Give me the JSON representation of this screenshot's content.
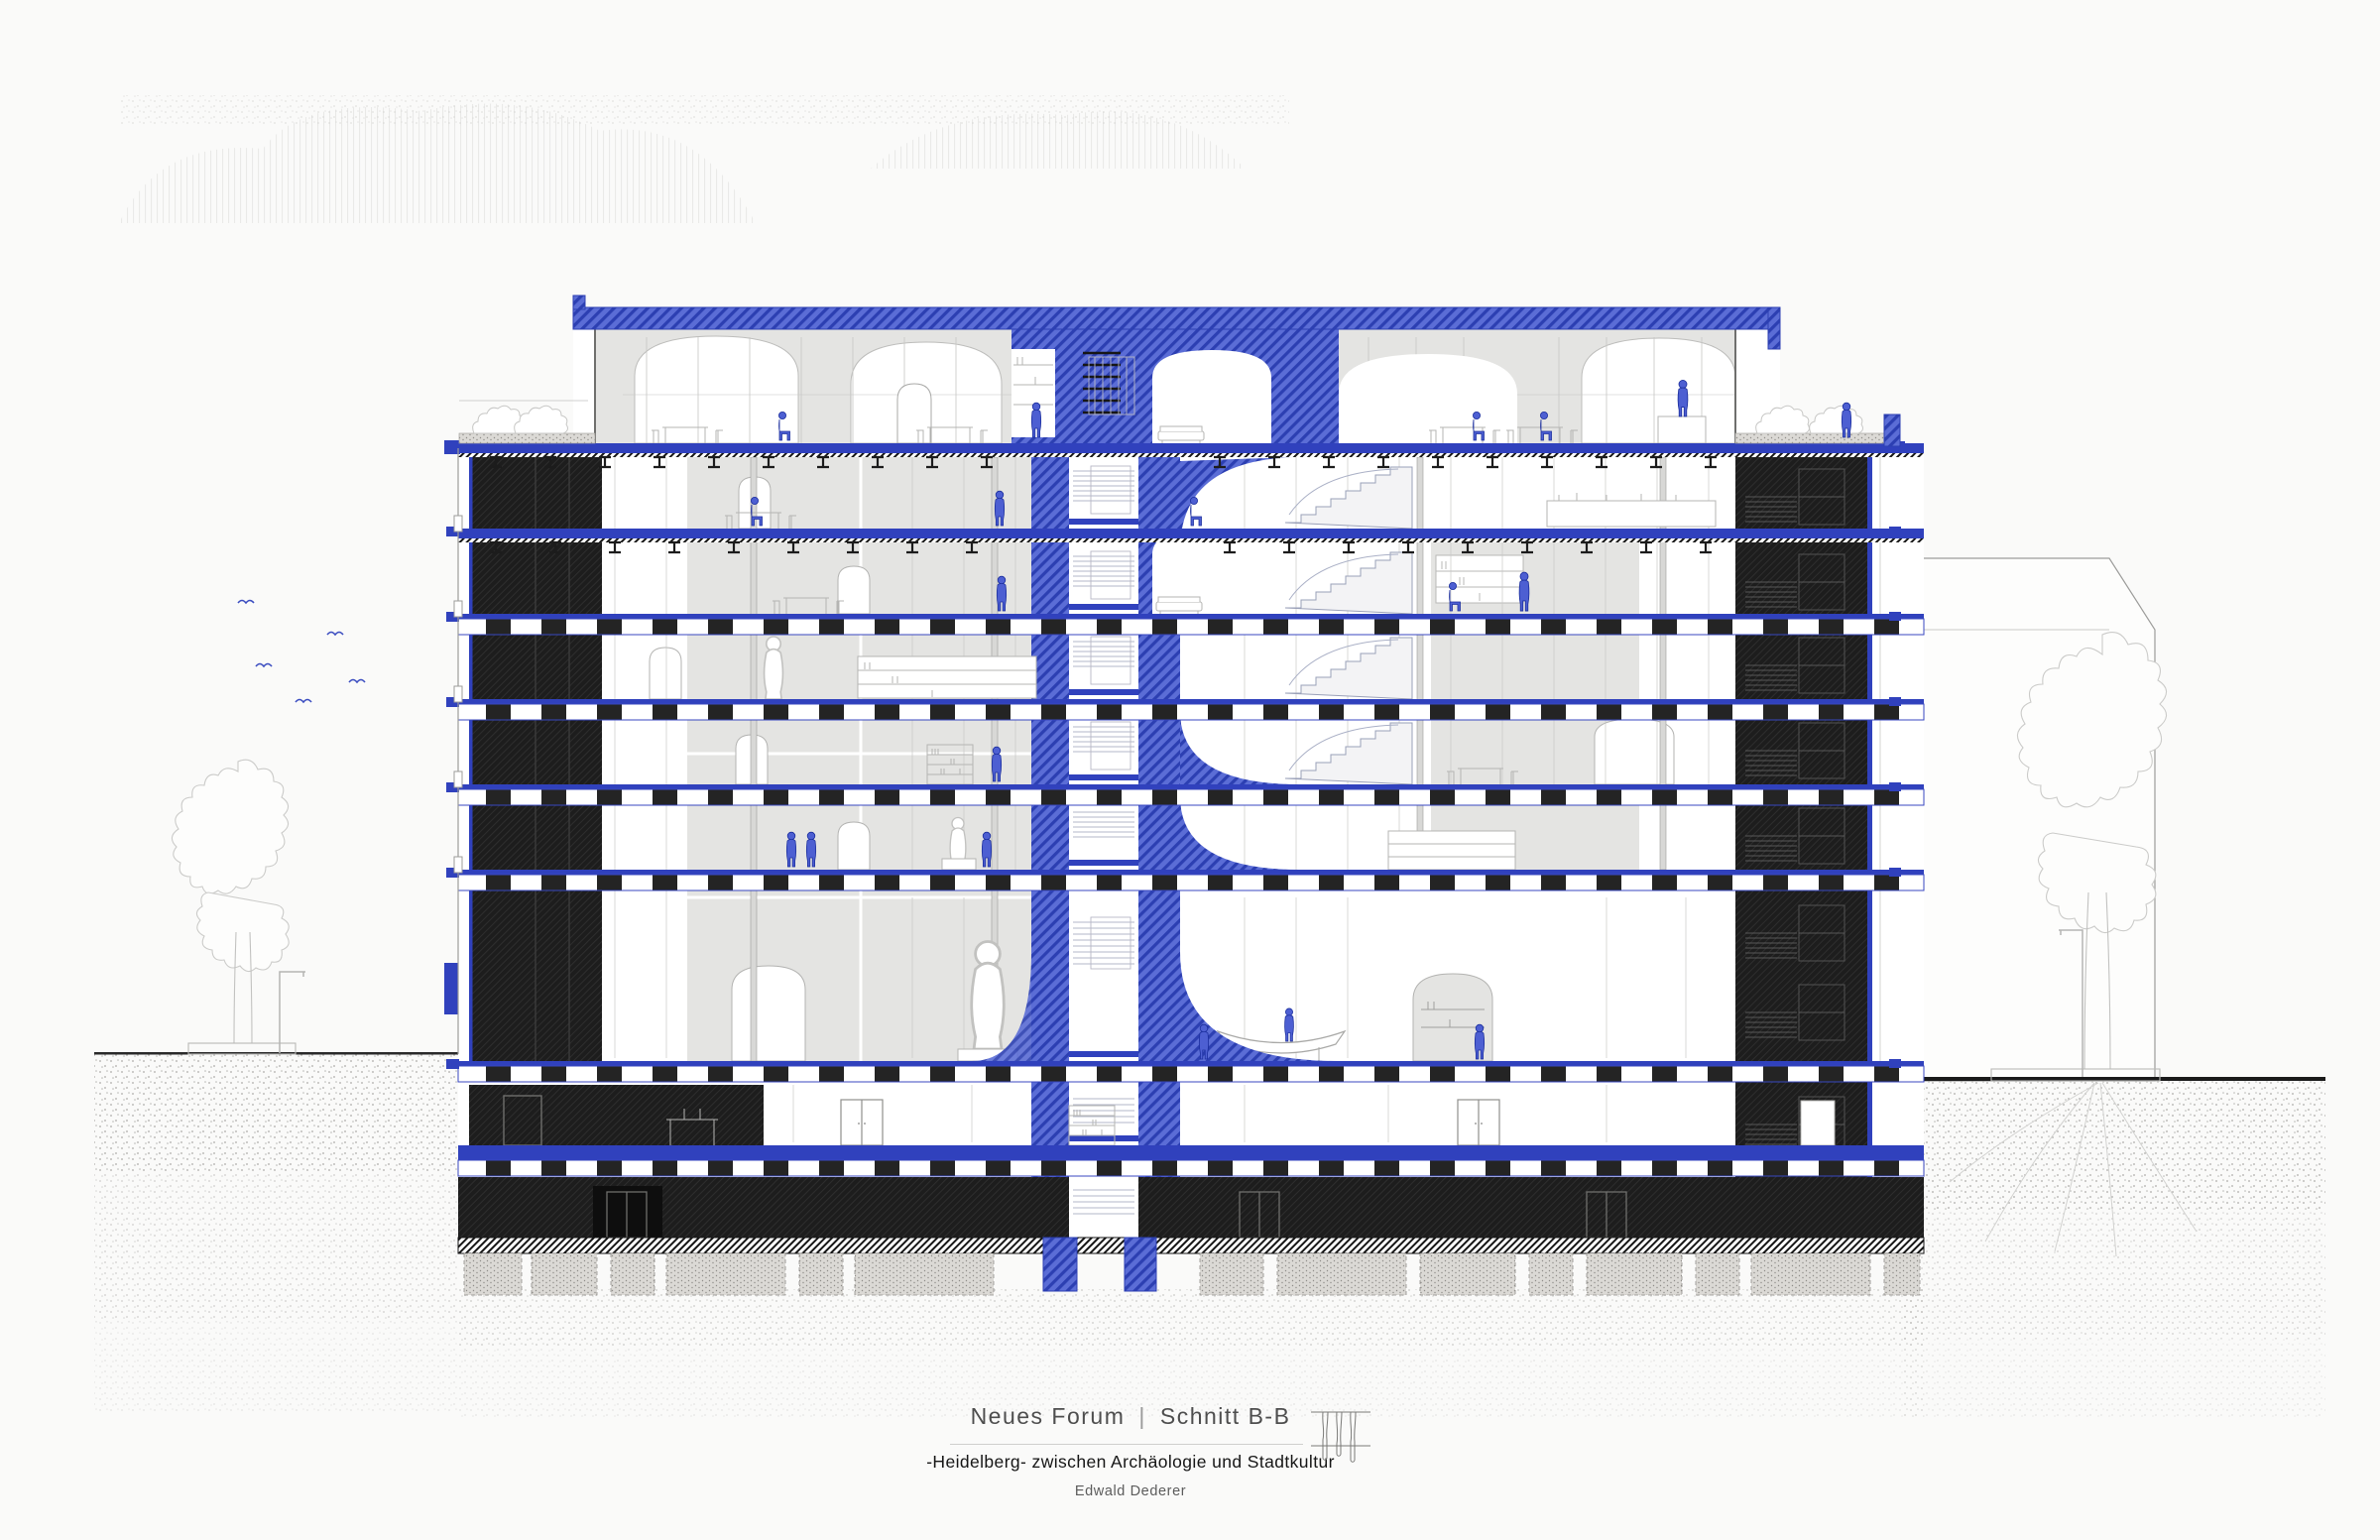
{
  "document": {
    "kind": "architectural-section-drawing",
    "title_block": {
      "project": "Neues Forum",
      "divider": "|",
      "sheet": "Schnitt B-B",
      "subtitle": "-Heidelberg- zwischen Archäologie und Stadtkultur",
      "author": "Edwald Dederer"
    }
  },
  "drawing": {
    "visible_features": [
      "central blue hatched stair core with foundations",
      "blue cantilevered roof slab over set-back penthouse",
      "roof terraces with shrubs at both ends",
      "dark hatched wall piers left and dark stair core right",
      "steel joist floor slabs on upper storeys",
      "castellated coffered slabs on lower storeys",
      "double-height museum hall with statue, boat exhibit and arched niches",
      "basement level with door openings and strip footings",
      "street trees, lamp posts, flying birds, neighbouring gabled building",
      "blue human figures on most levels"
    ],
    "storeys_above_ground": 8,
    "basement_levels": 1
  },
  "colors": {
    "background": "#fafaf9",
    "accent_blue_fill": "#5b6dd6",
    "accent_blue_hatch": "#2c3fb2",
    "slab_blue": "#3041bd",
    "figure_blue": "#4d5fd2",
    "dark_wall": "#1d1d1d",
    "interior_gray": "#e4e4e2",
    "furniture_line_gray": "#b5b5b3",
    "tree_line_gray": "#cbcbc9",
    "ground_dot_gray": "#a3a29f"
  }
}
